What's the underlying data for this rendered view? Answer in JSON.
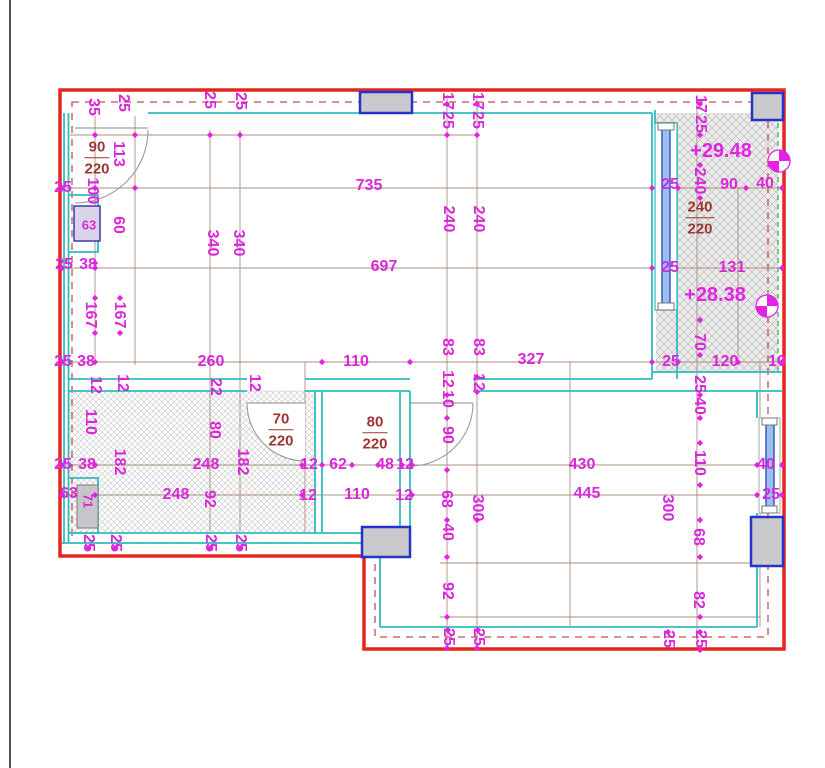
{
  "drawing": {
    "type": "apartment floor plan with dimension chains",
    "units": "cm",
    "colors": {
      "boundary_red": "#e5261f",
      "wall_cyan": "#2fbdbd",
      "dimension_magenta": "#d928d9",
      "door_label_red": "#9c3632",
      "column_fill": "#c9c9ce",
      "column_border": "#2633c8",
      "glass_blue": "#9cc0ee",
      "dashed_offset": "#c4504e",
      "dashed_green": "#3aa53a",
      "dim_line": "#ab8d7d"
    },
    "level_markers": [
      {
        "text": "+29.48",
        "x": 721,
        "y": 151
      },
      {
        "text": "+28.38",
        "x": 715,
        "y": 295
      }
    ],
    "door_window_labels": [
      {
        "width": "90",
        "height": "220",
        "x": 97,
        "y": 158
      },
      {
        "width": "240",
        "height": "220",
        "x": 700,
        "y": 218
      },
      {
        "width": "70",
        "height": "220",
        "x": 281,
        "y": 430
      },
      {
        "width": "80",
        "height": "220",
        "x": 375,
        "y": 433
      }
    ],
    "dimension_labels": [
      {
        "text": "35",
        "x": 93,
        "y": 107,
        "rot": 1
      },
      {
        "text": "25",
        "x": 123,
        "y": 103,
        "rot": 1
      },
      {
        "text": "25",
        "x": 209,
        "y": 100,
        "rot": 1
      },
      {
        "text": "25",
        "x": 240,
        "y": 101,
        "rot": 1
      },
      {
        "text": "17",
        "x": 447,
        "y": 101,
        "rot": 1
      },
      {
        "text": "25",
        "x": 447,
        "y": 120,
        "rot": 1
      },
      {
        "text": "17",
        "x": 477,
        "y": 101,
        "rot": 1
      },
      {
        "text": "25",
        "x": 477,
        "y": 120,
        "rot": 1
      },
      {
        "text": "17",
        "x": 700,
        "y": 104,
        "rot": 1
      },
      {
        "text": "25",
        "x": 700,
        "y": 124,
        "rot": 1
      },
      {
        "text": "25",
        "x": 63,
        "y": 188
      },
      {
        "text": "25",
        "x": 64,
        "y": 265
      },
      {
        "text": "38",
        "x": 88,
        "y": 265
      },
      {
        "text": "25",
        "x": 63,
        "y": 362
      },
      {
        "text": "38",
        "x": 86,
        "y": 362
      },
      {
        "text": "25",
        "x": 63,
        "y": 465
      },
      {
        "text": "38",
        "x": 87,
        "y": 465
      },
      {
        "text": "63",
        "x": 89,
        "y": 225,
        "fs": 13
      },
      {
        "text": "63",
        "x": 69,
        "y": 494
      },
      {
        "text": "71",
        "x": 88,
        "y": 501,
        "rot": 1,
        "fs": 13
      },
      {
        "text": "113",
        "x": 118,
        "y": 154,
        "rot": 1
      },
      {
        "text": "100",
        "x": 92,
        "y": 191,
        "rot": 1
      },
      {
        "text": "60",
        "x": 118,
        "y": 225,
        "rot": 1
      },
      {
        "text": "340",
        "x": 212,
        "y": 243,
        "rot": 1
      },
      {
        "text": "340",
        "x": 238,
        "y": 243,
        "rot": 1
      },
      {
        "text": "167",
        "x": 90,
        "y": 315,
        "rot": 1
      },
      {
        "text": "167",
        "x": 119,
        "y": 315,
        "rot": 1
      },
      {
        "text": "735",
        "x": 369,
        "y": 186
      },
      {
        "text": "697",
        "x": 384,
        "y": 267
      },
      {
        "text": "240",
        "x": 448,
        "y": 219,
        "rot": 1
      },
      {
        "text": "240",
        "x": 478,
        "y": 219,
        "rot": 1
      },
      {
        "text": "240",
        "x": 699,
        "y": 181,
        "rot": 1
      },
      {
        "text": "25",
        "x": 670,
        "y": 185
      },
      {
        "text": "90",
        "x": 729,
        "y": 185
      },
      {
        "text": "40",
        "x": 765,
        "y": 184
      },
      {
        "text": "25",
        "x": 670,
        "y": 268
      },
      {
        "text": "131",
        "x": 732,
        "y": 268
      },
      {
        "text": "70",
        "x": 699,
        "y": 342,
        "rot": 1
      },
      {
        "text": "25",
        "x": 671,
        "y": 362
      },
      {
        "text": "120",
        "x": 725,
        "y": 362
      },
      {
        "text": "10",
        "x": 777,
        "y": 362
      },
      {
        "text": "25",
        "x": 699,
        "y": 384,
        "rot": 1
      },
      {
        "text": "40",
        "x": 699,
        "y": 406,
        "rot": 1
      },
      {
        "text": "260",
        "x": 211,
        "y": 362
      },
      {
        "text": "110",
        "x": 356,
        "y": 362
      },
      {
        "text": "83",
        "x": 447,
        "y": 347,
        "rot": 1
      },
      {
        "text": "83",
        "x": 478,
        "y": 347,
        "rot": 1
      },
      {
        "text": "327",
        "x": 531,
        "y": 360
      },
      {
        "text": "12",
        "x": 447,
        "y": 379,
        "rot": 1
      },
      {
        "text": "10",
        "x": 447,
        "y": 399,
        "rot": 1
      },
      {
        "text": "12",
        "x": 478,
        "y": 382,
        "rot": 1
      },
      {
        "text": "12",
        "x": 95,
        "y": 385,
        "rot": 1
      },
      {
        "text": "12",
        "x": 122,
        "y": 383,
        "rot": 1
      },
      {
        "text": "22",
        "x": 215,
        "y": 387,
        "rot": 1
      },
      {
        "text": "12",
        "x": 254,
        "y": 383,
        "rot": 1
      },
      {
        "text": "110",
        "x": 90,
        "y": 422,
        "rot": 1
      },
      {
        "text": "80",
        "x": 214,
        "y": 430,
        "rot": 1
      },
      {
        "text": "182",
        "x": 119,
        "y": 462,
        "rot": 1
      },
      {
        "text": "182",
        "x": 242,
        "y": 462,
        "rot": 1
      },
      {
        "text": "248",
        "x": 206,
        "y": 465
      },
      {
        "text": "248",
        "x": 176,
        "y": 495
      },
      {
        "text": "92",
        "x": 209,
        "y": 499,
        "rot": 1
      },
      {
        "text": "12",
        "x": 309,
        "y": 465
      },
      {
        "text": "62",
        "x": 338,
        "y": 465
      },
      {
        "text": "48",
        "x": 385,
        "y": 465
      },
      {
        "text": "12",
        "x": 405,
        "y": 465
      },
      {
        "text": "12",
        "x": 308,
        "y": 496
      },
      {
        "text": "110",
        "x": 357,
        "y": 495
      },
      {
        "text": "12",
        "x": 404,
        "y": 496
      },
      {
        "text": "90",
        "x": 447,
        "y": 435,
        "rot": 1
      },
      {
        "text": "68",
        "x": 446,
        "y": 499,
        "rot": 1
      },
      {
        "text": "300",
        "x": 477,
        "y": 508,
        "rot": 1
      },
      {
        "text": "40",
        "x": 447,
        "y": 532,
        "rot": 1
      },
      {
        "text": "92",
        "x": 447,
        "y": 591,
        "rot": 1
      },
      {
        "text": "430",
        "x": 582,
        "y": 465
      },
      {
        "text": "445",
        "x": 587,
        "y": 494
      },
      {
        "text": "110",
        "x": 699,
        "y": 463,
        "rot": 1
      },
      {
        "text": "300",
        "x": 667,
        "y": 508,
        "rot": 1
      },
      {
        "text": "68",
        "x": 698,
        "y": 537,
        "rot": 1
      },
      {
        "text": "82",
        "x": 698,
        "y": 600,
        "rot": 1
      },
      {
        "text": "40",
        "x": 766,
        "y": 465
      },
      {
        "text": "25",
        "x": 771,
        "y": 495
      },
      {
        "text": "25",
        "x": 88,
        "y": 543,
        "rot": 1
      },
      {
        "text": "25",
        "x": 115,
        "y": 543,
        "rot": 1
      },
      {
        "text": "25",
        "x": 210,
        "y": 543,
        "rot": 1
      },
      {
        "text": "25",
        "x": 240,
        "y": 543,
        "rot": 1
      },
      {
        "text": "25",
        "x": 448,
        "y": 637,
        "rot": 1
      },
      {
        "text": "25",
        "x": 478,
        "y": 637,
        "rot": 1
      },
      {
        "text": "25",
        "x": 668,
        "y": 639,
        "rot": 1
      },
      {
        "text": "25",
        "x": 700,
        "y": 639,
        "rot": 1
      }
    ]
  }
}
